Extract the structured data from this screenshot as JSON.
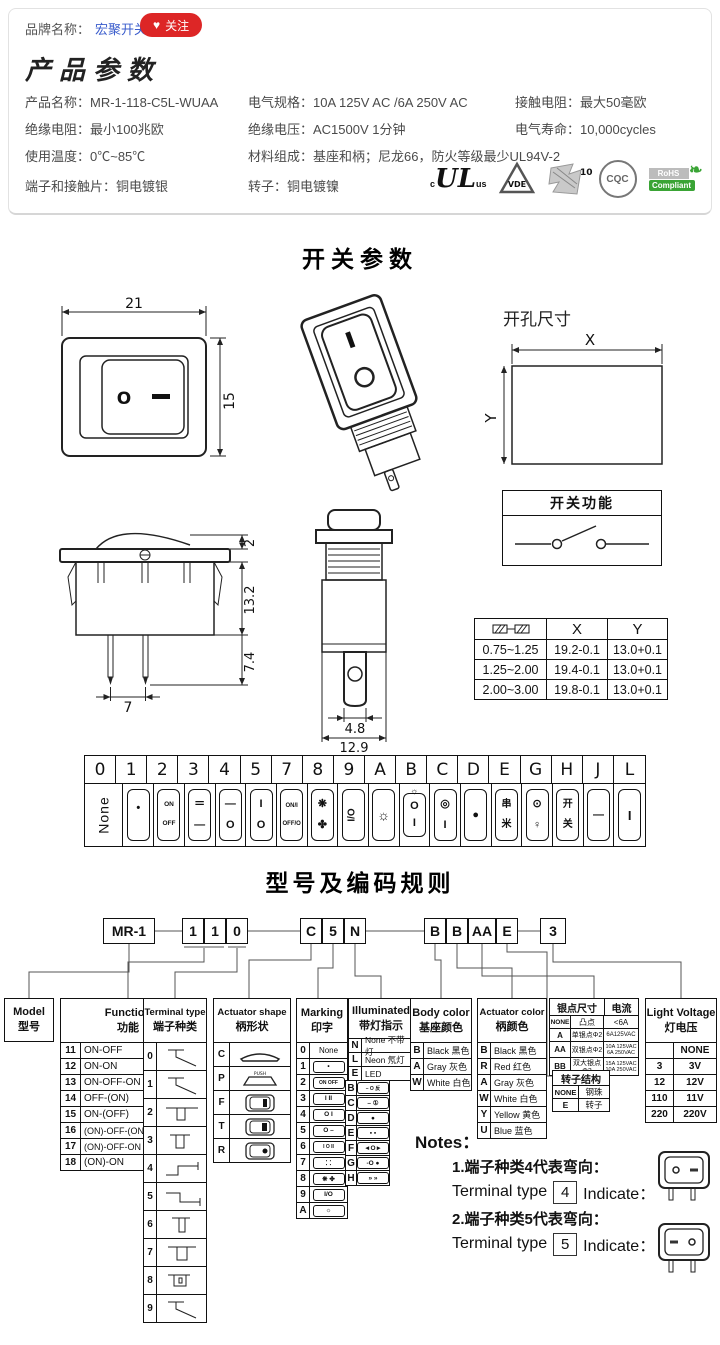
{
  "colors": {
    "accent_red": "#dd2626",
    "link_blue": "#3a5ccc",
    "rohs_green": "#3aa435",
    "text": "#4a4a4a"
  },
  "brand": {
    "label": "品牌名称：",
    "name": "宏聚开关",
    "heart": "♥",
    "follow": "关注"
  },
  "product_params": {
    "title": "产品参数",
    "r1c1": "产品名称：MR-1-118-C5L-WUAA",
    "r1c2": "电气规格：10A  125V  AC /6A 250V  AC",
    "r1c3": "接触电阻：最大50毫欧",
    "r2c1": "绝缘电阻：最小100兆欧",
    "r2c2": "绝缘电压：AC1500V 1分钟",
    "r2c3": "电气寿命：10,000cycles",
    "r3c1": "使用温度：0℃~85℃",
    "r3c2": "材料组成：基座和柄；尼龙66，防火等级最少UL94V-2",
    "r4c1": "端子和接触片：铜电镀银",
    "r4c2": "转子：铜电镀镍",
    "certs": {
      "ul_c": "c",
      "ul": "UL",
      "ul_us": "us",
      "vde": "VDE",
      "enec": "10",
      "cqc": "CQC",
      "rohs1": "RoHS",
      "rohs2": "Compliant",
      "leaf": "❧"
    }
  },
  "switch_section": {
    "title": "开关参数",
    "front": {
      "dim_w": "21",
      "dim_h": "15",
      "sym_o": "O"
    },
    "iso": {
      "sym_o": "O"
    },
    "hole": {
      "label": "开孔尺寸",
      "x": "X",
      "y": "Y"
    },
    "side": {
      "d_top": "2",
      "d_body": "13.2",
      "d_pin": "7.4",
      "d_pitch": "7"
    },
    "end": {
      "d_pin": "4.8",
      "d_total": "12.9"
    },
    "func_box": {
      "title": "开关功能"
    },
    "tol_table": {
      "hx": "X",
      "hy": "Y",
      "rows": [
        [
          "0.75~1.25",
          "19.2-0.1",
          "13.0+0.1"
        ],
        [
          "1.25~2.00",
          "19.4-0.1",
          "13.0+0.1"
        ],
        [
          "2.00~3.00",
          "19.8-0.1",
          "13.0+0.1"
        ]
      ]
    }
  },
  "marking_table": {
    "columns": [
      {
        "code": "0",
        "t": "None"
      },
      {
        "code": "1",
        "t": "•",
        "b": ""
      },
      {
        "code": "2",
        "t": "ON",
        "b": "OFF"
      },
      {
        "code": "3",
        "t": "＝",
        "b": "—"
      },
      {
        "code": "4",
        "t": "—",
        "b": "O"
      },
      {
        "code": "5",
        "t": "I",
        "b": "O"
      },
      {
        "code": "7",
        "t": "ON/I",
        "b": "OFF/O"
      },
      {
        "code": "8",
        "t": "❋",
        "b": "✤"
      },
      {
        "code": "9",
        "t": "I/O",
        "b": ""
      },
      {
        "code": "A",
        "t": "☼",
        "b": ""
      },
      {
        "code": "B",
        "above": "☼",
        "t": "O",
        "b": "I"
      },
      {
        "code": "C",
        "t": "◎",
        "b": "I"
      },
      {
        "code": "D",
        "t": "●",
        "b": ""
      },
      {
        "code": "E",
        "t": "串",
        "b": "米"
      },
      {
        "code": "G",
        "t": "⊙",
        "b": "♀"
      },
      {
        "code": "H",
        "t": "开",
        "b": "关"
      },
      {
        "code": "J",
        "t": "—",
        "b": ""
      },
      {
        "code": "L",
        "t": "I",
        "b": ""
      }
    ]
  },
  "coding": {
    "title": "型号及编码规则",
    "codes": {
      "g1": "MR-1",
      "g2a": "1",
      "g2b": "1",
      "g2c": "0",
      "g3a": "C",
      "g3b": "5",
      "g3c": "N",
      "g4a": "B",
      "g4b": "B",
      "g4c": "AA",
      "g4d": "E",
      "g5": "3"
    },
    "model": {
      "en": "Model",
      "cn": "型号"
    },
    "func": {
      "en": "Function",
      "cn": "功能",
      "rows": [
        [
          "11",
          "ON-OFF",
          "2P"
        ],
        [
          "12",
          "ON-ON",
          "3P"
        ],
        [
          "13",
          "ON-OFF-ON",
          "3P"
        ],
        [
          "14",
          "OFF-(ON)",
          "2P"
        ],
        [
          "15",
          "ON-(OFF)",
          "2P"
        ],
        [
          "16",
          "(ON)-OFF-(ON)",
          "3P"
        ],
        [
          "17",
          "(ON)-OFF-ON",
          "3P"
        ],
        [
          "18",
          "(ON)-ON",
          "3P"
        ]
      ]
    },
    "terminal": {
      "en": "Terminal type",
      "cn": "端子种类",
      "codes": [
        "0",
        "1",
        "2",
        "3",
        "4",
        "5",
        "6",
        "7",
        "8",
        "9"
      ]
    },
    "shape": {
      "en": "Actuator shape",
      "cn": "柄形状",
      "codes": [
        "C",
        "P",
        "F",
        "T",
        "R"
      ],
      "push": "PUSH"
    },
    "marking": {
      "en": "Marking",
      "cn": "印字",
      "left": [
        [
          "0",
          "None"
        ],
        [
          "1",
          "•"
        ],
        [
          "2",
          "ON OFF"
        ],
        [
          "3",
          "I II"
        ],
        [
          "4",
          "O I"
        ],
        [
          "5",
          "O –"
        ],
        [
          "6",
          "I O II"
        ],
        [
          "7",
          "⁚ ⁚"
        ],
        [
          "8",
          "❋ ✤"
        ],
        [
          "9",
          "I/O"
        ],
        [
          "A",
          "☼"
        ]
      ],
      "right": [
        [
          "B",
          "– O 反"
        ],
        [
          "C",
          "– ①"
        ],
        [
          "D",
          "●"
        ],
        [
          "E",
          "▪ ▪"
        ],
        [
          "F",
          "◄O►"
        ],
        [
          "G",
          "-O ●"
        ],
        [
          "H",
          "» »"
        ]
      ]
    },
    "illuminated": {
      "en": "Illuminated",
      "cn": "带灯指示",
      "rows": [
        [
          "N",
          "None 不带灯"
        ],
        [
          "L",
          "Neon 氖灯"
        ],
        [
          "E",
          "LED"
        ]
      ]
    },
    "body_color": {
      "en": "Body color",
      "cn": "基座颜色",
      "rows": [
        [
          "B",
          "Black 黑色"
        ],
        [
          "A",
          "Gray 灰色"
        ],
        [
          "W",
          "White 白色"
        ]
      ]
    },
    "act_color": {
      "en": "Actuator color",
      "cn": "柄颜色",
      "rows": [
        [
          "B",
          "Black 黑色"
        ],
        [
          "R",
          "Red 红色"
        ],
        [
          "A",
          "Gray 灰色"
        ],
        [
          "W",
          "White 白色"
        ],
        [
          "Y",
          "Yellow 黄色"
        ],
        [
          "U",
          "Blue 蓝色"
        ]
      ]
    },
    "silver": {
      "h1": "银点尺寸",
      "h2": "电流",
      "rows": [
        [
          "NONE",
          "凸点",
          "<6A"
        ],
        [
          "A",
          "单银点Φ2",
          "6A125VAC"
        ],
        [
          "AA",
          "双银点Φ2",
          "10A 125VAC 6A 250VAC"
        ],
        [
          "BB",
          "双大银点Φ3",
          "15A 125VAC 10A 250VAC"
        ]
      ]
    },
    "rotor": {
      "title": "转子结构",
      "rows": [
        [
          "NONE",
          "钢珠"
        ],
        [
          "E",
          "转子"
        ]
      ]
    },
    "light": {
      "en": "Light Voltage",
      "cn": "灯电压",
      "rows": [
        [
          "",
          "NONE"
        ],
        [
          "3",
          "3V"
        ],
        [
          "12",
          "12V"
        ],
        [
          "110",
          "11V"
        ],
        [
          "220",
          "220V"
        ]
      ]
    }
  },
  "notes": {
    "title": "Notes：",
    "n1_cn": "1.端子种类4代表弯向：",
    "n1_pre": "Terminal type",
    "n1_code": "4",
    "n1_post": "Indicate：",
    "n2_cn": "2.端子种类5代表弯向：",
    "n2_pre": "Terminal type",
    "n2_code": "5",
    "n2_post": "Indicate："
  }
}
